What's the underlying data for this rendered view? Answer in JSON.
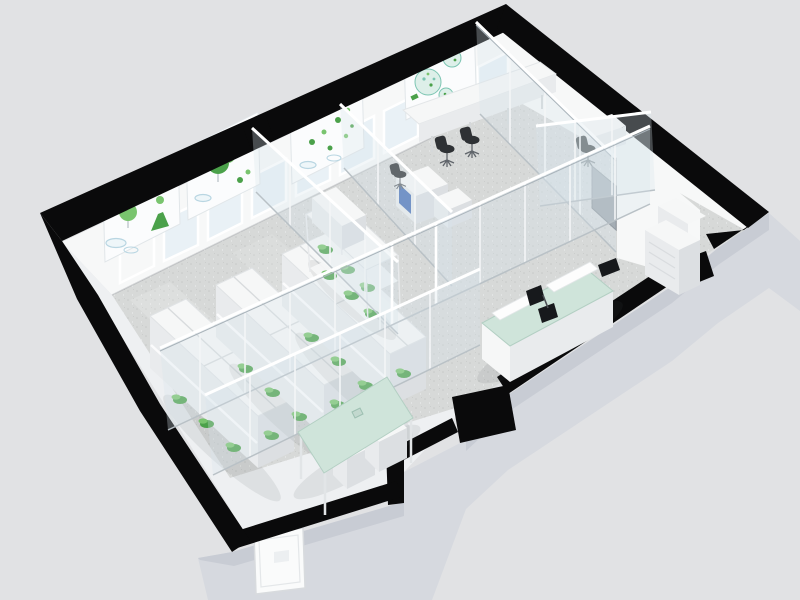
{
  "scene": {
    "title": "3D isometric cutaway rendering of a laboratory floor plan",
    "view": "isometric cutaway, viewed from the south-east",
    "background": "#e1e2e4"
  },
  "colors": {
    "bg": "#e1e2e4",
    "cut": "#0a0a0b",
    "floor": "#d7d9d8",
    "speckle1": "#c7c9c8",
    "speckle2": "#edefee",
    "wall": "#f7f8f8",
    "wallsh": "#eef0f2",
    "ext": "#d6d9df",
    "extsh": "#c8ccd4",
    "glass": "#d8e6ea",
    "win": "#e9f1f6",
    "mint": "#cfe4da",
    "mintedge": "#b3cfc3",
    "furn": "#f6f7f7",
    "furnsh": "#e9ebed",
    "furndk": "#dcdfe2",
    "green": "#4ba14a",
    "green2": "#79c46e",
    "teal": "#7cc5b2",
    "tealpale": "#ddefe9",
    "equip": "#4a72b8",
    "graydoor": "#8f959d",
    "chair": "#2e3134"
  },
  "building": {
    "outline": "thick black cut walls with door openings",
    "openings": {
      "exterior_doors": 3,
      "windows": 9,
      "interior_glass_doors": 2
    },
    "rooms": [
      {
        "name": "plant-culture-lab",
        "furniture": [
          "lab bench module x3",
          "plant shelving rack",
          "botanical wall posters x3",
          "window row"
        ]
      },
      {
        "name": "inner-instrument-rooms",
        "furniture": [
          "equipment desk with blue panel",
          "instrument cart",
          "task chair"
        ]
      },
      {
        "name": "office",
        "furniture": [
          "wall counter desk",
          "task chairs x3",
          "algae poster",
          "windows"
        ]
      },
      {
        "name": "open-lab-area",
        "furniture": [
          "island bench with glass top",
          "microscopes x2",
          "sink unit",
          "storage cabinets",
          "gray wall panel"
        ]
      },
      {
        "name": "meeting-area",
        "furniture": [
          "glass-top meeting table",
          "storage boxes x2"
        ]
      },
      {
        "name": "entrance-vestibule",
        "furniture": [
          "white exterior door"
        ]
      }
    ]
  }
}
